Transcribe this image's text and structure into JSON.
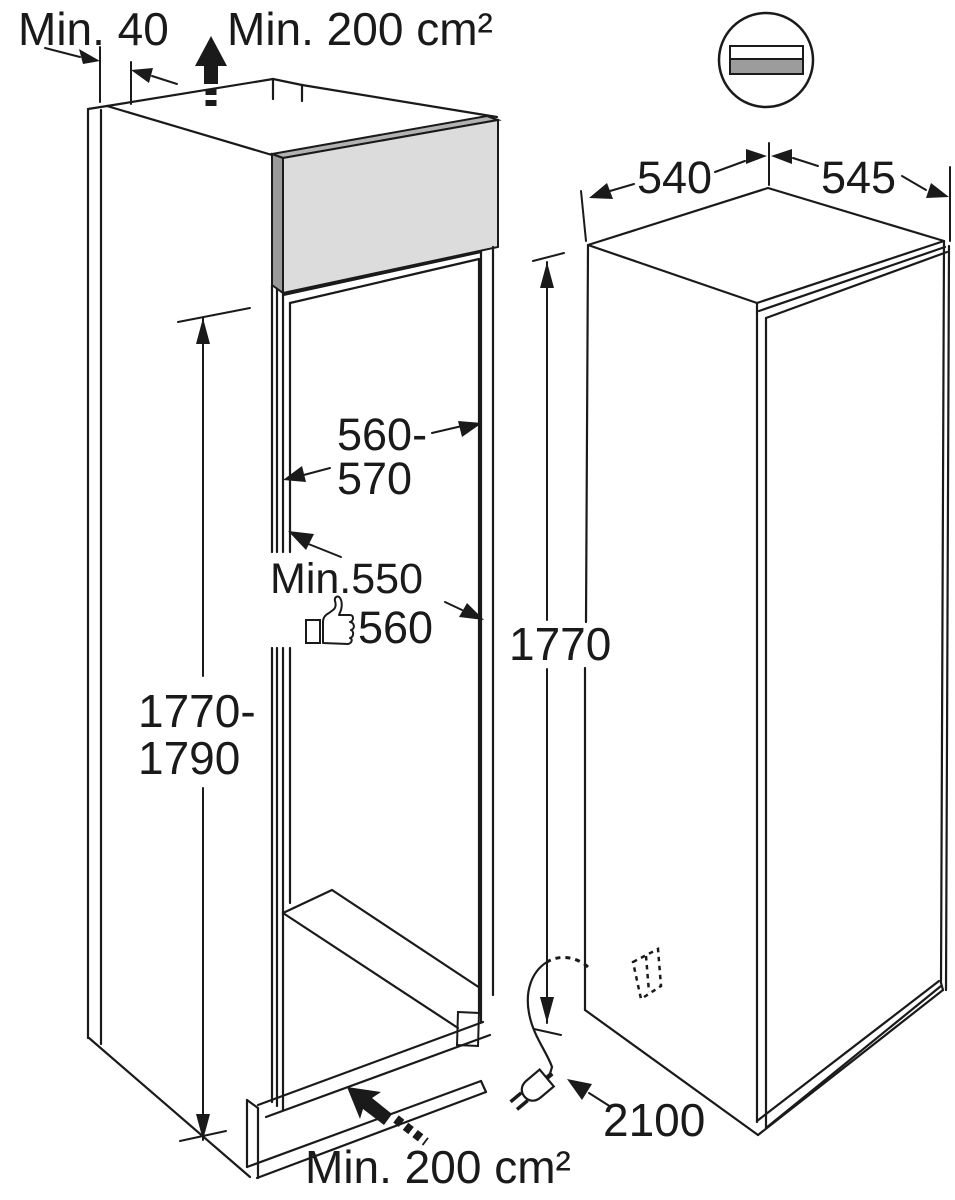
{
  "diagram": {
    "kind": "built-in appliance niche and appliance dimension drawing",
    "niche": {
      "rear_gap_label": "Min. 40",
      "top_vent_label": "Min. 200 cm²",
      "width_label_line1": "560-",
      "width_label_line2": "570",
      "depth_label_min": "Min.550",
      "depth_label_recommended": "560",
      "height_label_line1": "1770-",
      "height_label_line2": "1790",
      "bottom_vent_label": "Min. 200 cm²"
    },
    "appliance": {
      "height_label": "1770",
      "depth_label": "540",
      "width_label": "545",
      "cord_length_label": "2100"
    },
    "icons": {
      "vent_grille": "vent-grille-icon",
      "thumbs_up": "thumbs-up-icon",
      "power_plug": "power-plug-icon",
      "airflow_top": "airflow-up-arrow-icon",
      "airflow_bottom": "airflow-plinth-arrow-icon",
      "socket_position": "socket-outline-icon"
    },
    "colors": {
      "line": "#1a1a1a",
      "panel_front": "#dcdcdc",
      "panel_top": "#b2b2b2",
      "panel_side": "#9a9a9a",
      "grille_bar": "#9c9c9c",
      "background": "#ffffff"
    }
  }
}
